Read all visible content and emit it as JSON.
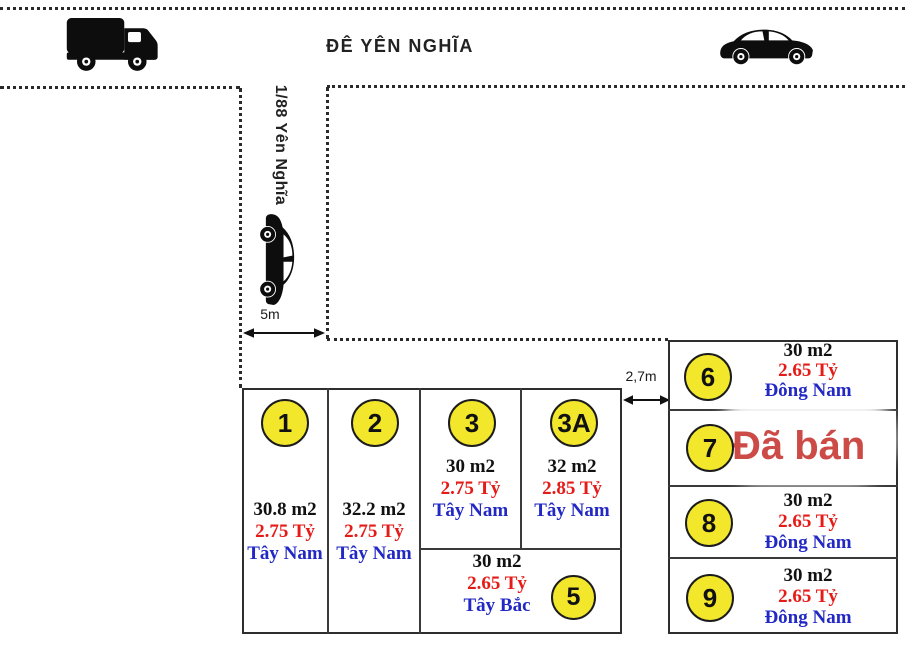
{
  "labels": {
    "main_road": "ĐÊ YÊN NGHĨA",
    "side_road": "1/88 Yên Nghĩa",
    "side_road_width": "5m",
    "alley_width": "2,7m"
  },
  "plots": [
    {
      "id": "1",
      "area": "30.8 m2",
      "price": "2.75 Tỷ",
      "direction": "Tây Nam"
    },
    {
      "id": "2",
      "area": "32.2 m2",
      "price": "2.75 Tỷ",
      "direction": "Tây Nam"
    },
    {
      "id": "3",
      "area": "30 m2",
      "price": "2.75 Tỷ",
      "direction": "Tây Nam"
    },
    {
      "id": "3A",
      "area": "32 m2",
      "price": "2.85 Tỷ",
      "direction": "Tây Nam"
    },
    {
      "id": "5",
      "area": "30 m2",
      "price": "2.65 Tỷ",
      "direction": "Tây Bắc"
    },
    {
      "id": "6",
      "area": "30 m2",
      "price": "2.65 Tỷ",
      "direction": "Đông Nam"
    },
    {
      "id": "7",
      "status": "Đã bán"
    },
    {
      "id": "8",
      "area": "30 m2",
      "price": "2.65 Tỷ",
      "direction": "Đông Nam"
    },
    {
      "id": "9",
      "area": "30 m2",
      "price": "2.65 Tỷ",
      "direction": "Đông Nam"
    }
  ],
  "colors": {
    "circle_fill": "#F2E72B",
    "price": "#E41B17",
    "direction": "#2228C4",
    "sold": "#CC4B47",
    "line": "#2e2e2e"
  },
  "icons": {
    "truck": "truck-icon",
    "car_main_road": "car-icon",
    "car_side_road": "car-vertical-icon"
  }
}
